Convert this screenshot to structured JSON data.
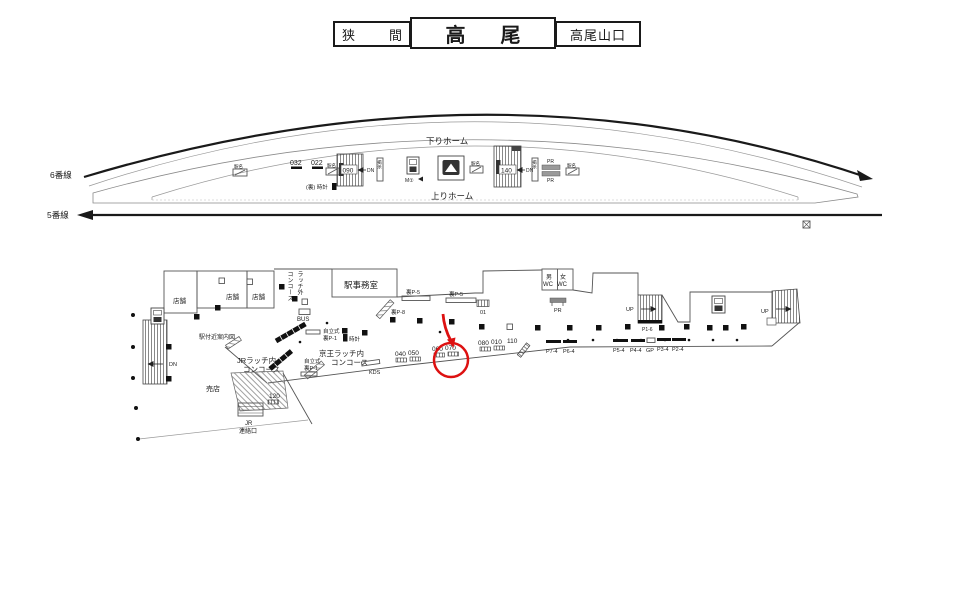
{
  "header": {
    "left": "狭間",
    "center": "高尾",
    "right": "高尾山口"
  },
  "tracks": {
    "line6": "6番線",
    "line5": "5番線"
  },
  "platform": {
    "down_home": "下りホーム",
    "up_home": "上りホーム",
    "ekimei": "駅名",
    "n032": "032",
    "n022": "022",
    "n090": "090",
    "n140": "140",
    "dn": "DN",
    "clock_back": "(裏) 時計",
    "board": "掲示",
    "vending": "M①",
    "pr": "PR"
  },
  "concourse": {
    "shop": "店舗",
    "office": "駅事務室",
    "latch_out_line1": "ラッチ外",
    "latch_out_line2": "コンコース",
    "jr_latch_line1": "JRラッチ内",
    "jr_latch_line2": "コンコース",
    "keio_latch_line1": "京王ラッチ内",
    "keio_latch_line2": "コンコース",
    "area_map": "駅付近案内図",
    "kiosk": "売店",
    "jr_gate_line1": "JR",
    "jr_gate_line2": "連絡口",
    "bus": "BUS",
    "kds": "KDS",
    "pr": "PR",
    "up": "UP",
    "dn": "DN",
    "clock": "時計",
    "selfstand": "自立式",
    "p1_back": "裏P-1",
    "p5_back": "裏P-5",
    "p8_back": "裏P-8",
    "pos01": "01",
    "p16": "P1-6",
    "wc_m": "男",
    "wc_w": "女",
    "wc": "WC",
    "n040": "040",
    "n050": "050",
    "n060": "060",
    "n070": "070",
    "n080": "080",
    "n010": "010",
    "n110": "110",
    "n120": "120",
    "floor_labels": [
      "P7-4",
      "P6-4",
      "P5-4",
      "P4-4",
      "GP",
      "P3-4",
      "P2-4"
    ]
  },
  "colors": {
    "annotation": "#dd1111",
    "line": "#1a1a1a"
  }
}
